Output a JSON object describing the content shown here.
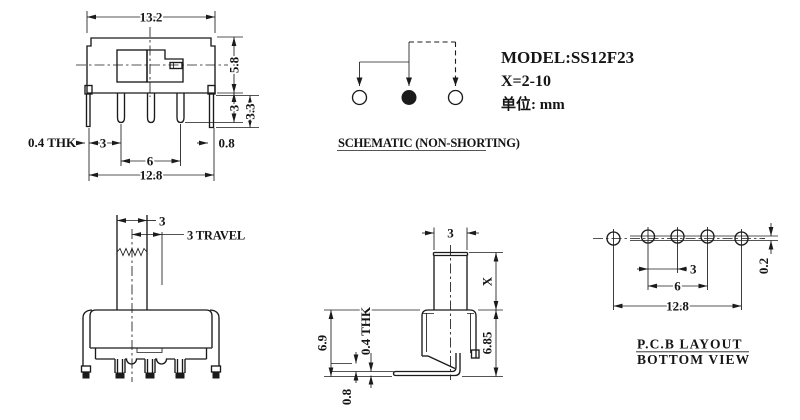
{
  "title_block": {
    "model": "MODEL:SS12F23",
    "x_range": "X=2-10",
    "units": "单位: mm"
  },
  "schematic": {
    "caption": "SCHEMATIC (NON-SHORTING)"
  },
  "top_view": {
    "dim_width": "13.2",
    "dim_height": "5.8",
    "dim_pin_length": "3",
    "dim_leg_length": "3.3",
    "dim_thickness": "0.4 THK",
    "dim_pitch": "3",
    "dim_span": "6",
    "dim_leg_width": "0.8",
    "dim_total": "12.8"
  },
  "front_view": {
    "dim_knob_width": "3",
    "dim_travel": "3 TRAVEL"
  },
  "side_view": {
    "dim_knob_width": "3",
    "dim_knob_height": "X",
    "dim_body_height": "6.9",
    "dim_cover_height": "6.85",
    "dim_thickness": "0.4 THK",
    "dim_offset": "0.8"
  },
  "pcb_view": {
    "caption_line1": "P.C.B LAYOUT",
    "caption_line2": "BOTTOM VIEW",
    "dim_pitch": "3",
    "dim_span": "6",
    "dim_total": "12.8",
    "dim_offset": "0.2"
  },
  "colors": {
    "line": "#1b1b1b",
    "background": "#ffffff"
  }
}
